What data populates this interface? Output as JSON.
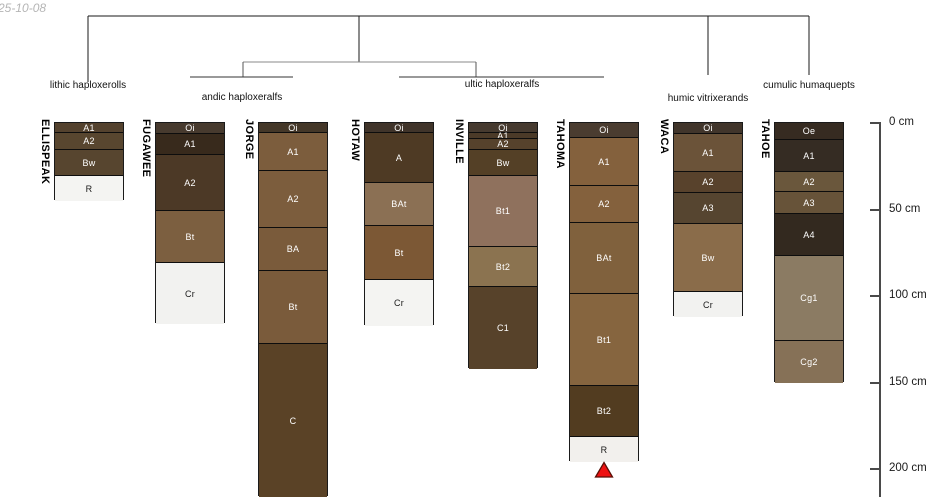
{
  "meta": {
    "date_label": "25-10-08"
  },
  "chart_data": {
    "type": "bar",
    "subtype": "stacked-soil-profile-sketch",
    "title": "",
    "depth_axis": {
      "unit": "cm",
      "position": "right",
      "range": [
        0,
        216
      ],
      "tick_values": [
        0,
        50,
        100,
        150,
        200
      ],
      "tick_labels": [
        "0 cm",
        "50 cm",
        "100 cm",
        "150 cm",
        "200 cm"
      ]
    },
    "dendrogram_groups": [
      {
        "label": "lithic haploxerolls",
        "members": [
          "ELLISPEAK"
        ]
      },
      {
        "label": "andic haploxeralfs",
        "members": [
          "FUGAWEE",
          "JORGE"
        ]
      },
      {
        "label": "ultic haploxeralfs",
        "members": [
          "HOTAW",
          "INVILLE",
          "TAHOMA"
        ]
      },
      {
        "label": "humic vitrixerands",
        "members": [
          "WACA"
        ]
      },
      {
        "label": "cumulic humaquepts",
        "members": [
          "TAHOE"
        ]
      }
    ],
    "profiles": [
      {
        "name": "ELLISPEAK",
        "group": "lithic haploxerolls",
        "horizons": [
          {
            "name": "A1",
            "top_cm": 0,
            "bottom_cm": 5,
            "color": "#54422e",
            "label_color": "#ffffff"
          },
          {
            "name": "A2",
            "top_cm": 5,
            "bottom_cm": 15,
            "color": "#58462f",
            "label_color": "#ffffff"
          },
          {
            "name": "Bw",
            "top_cm": 15,
            "bottom_cm": 30,
            "color": "#57452f",
            "label_color": "#ffffff"
          },
          {
            "name": "R",
            "top_cm": 30,
            "bottom_cm": 45,
            "color": "#f4f4f2",
            "label_color": "#1a1a1a"
          }
        ]
      },
      {
        "name": "FUGAWEE",
        "group": "andic haploxeralfs",
        "horizons": [
          {
            "name": "Oi",
            "top_cm": 0,
            "bottom_cm": 6,
            "color": "#473a2e",
            "label_color": "#ffffff"
          },
          {
            "name": "A1",
            "top_cm": 6,
            "bottom_cm": 18,
            "color": "#382a1c",
            "label_color": "#ffffff"
          },
          {
            "name": "A2",
            "top_cm": 18,
            "bottom_cm": 50,
            "color": "#4c3926",
            "label_color": "#ffffff"
          },
          {
            "name": "Bt",
            "top_cm": 50,
            "bottom_cm": 80,
            "color": "#7c5f40",
            "label_color": "#ffffff"
          },
          {
            "name": "Cr",
            "top_cm": 80,
            "bottom_cm": 116,
            "color": "#f2f2f0",
            "label_color": "#1a1a1a"
          }
        ]
      },
      {
        "name": "JORGE",
        "group": "andic haploxeralfs",
        "horizons": [
          {
            "name": "Oi",
            "top_cm": 0,
            "bottom_cm": 5,
            "color": "#443728",
            "label_color": "#ffffff"
          },
          {
            "name": "A1",
            "top_cm": 5,
            "bottom_cm": 27,
            "color": "#7c5d3d",
            "label_color": "#ffffff"
          },
          {
            "name": "A2",
            "top_cm": 27,
            "bottom_cm": 60,
            "color": "#7c5d3d",
            "label_color": "#ffffff"
          },
          {
            "name": "BA",
            "top_cm": 60,
            "bottom_cm": 85,
            "color": "#7a5b3b",
            "label_color": "#ffffff"
          },
          {
            "name": "Bt",
            "top_cm": 85,
            "bottom_cm": 127,
            "color": "#7a5b3b",
            "label_color": "#ffffff"
          },
          {
            "name": "C",
            "top_cm": 127,
            "bottom_cm": 216,
            "color": "#5a4226",
            "label_color": "#ffffff"
          }
        ]
      },
      {
        "name": "HOTAW",
        "group": "ultic haploxeralfs",
        "horizons": [
          {
            "name": "Oi",
            "top_cm": 0,
            "bottom_cm": 5,
            "color": "#40342a",
            "label_color": "#ffffff"
          },
          {
            "name": "A",
            "top_cm": 5,
            "bottom_cm": 34,
            "color": "#4e3a24",
            "label_color": "#ffffff"
          },
          {
            "name": "BAt",
            "top_cm": 34,
            "bottom_cm": 59,
            "color": "#8b7054",
            "label_color": "#ffffff"
          },
          {
            "name": "Bt",
            "top_cm": 59,
            "bottom_cm": 90,
            "color": "#7c5835",
            "label_color": "#ffffff"
          },
          {
            "name": "Cr",
            "top_cm": 90,
            "bottom_cm": 117,
            "color": "#f4f4f2",
            "label_color": "#1a1a1a"
          }
        ]
      },
      {
        "name": "INVILLE",
        "group": "ultic haploxeralfs",
        "horizons": [
          {
            "name": "Oi",
            "top_cm": 0,
            "bottom_cm": 5,
            "color": "#463a2f",
            "label_color": "#ffffff"
          },
          {
            "name": "A1",
            "top_cm": 5,
            "bottom_cm": 8.5,
            "color": "#4b3a28",
            "label_color": "#ffffff"
          },
          {
            "name": "A2",
            "top_cm": 8.5,
            "bottom_cm": 15,
            "color": "#56422c",
            "label_color": "#ffffff"
          },
          {
            "name": "Bw",
            "top_cm": 15,
            "bottom_cm": 30,
            "color": "#544026",
            "label_color": "#ffffff"
          },
          {
            "name": "Bt1",
            "top_cm": 30,
            "bottom_cm": 71,
            "color": "#8f715d",
            "label_color": "#ffffff"
          },
          {
            "name": "Bt2",
            "top_cm": 71,
            "bottom_cm": 94,
            "color": "#8b7350",
            "label_color": "#ffffff"
          },
          {
            "name": "C1",
            "top_cm": 94,
            "bottom_cm": 142,
            "color": "#57422a",
            "label_color": "#ffffff"
          }
        ]
      },
      {
        "name": "TAHOMA",
        "group": "ultic haploxeralfs",
        "horizons": [
          {
            "name": "Oi",
            "top_cm": 0,
            "bottom_cm": 8,
            "color": "#4a3c30",
            "label_color": "#ffffff"
          },
          {
            "name": "A1",
            "top_cm": 8,
            "bottom_cm": 36,
            "color": "#84613d",
            "label_color": "#ffffff"
          },
          {
            "name": "A2",
            "top_cm": 36,
            "bottom_cm": 57,
            "color": "#84613d",
            "label_color": "#ffffff"
          },
          {
            "name": "BAt",
            "top_cm": 57,
            "bottom_cm": 98,
            "color": "#80613d",
            "label_color": "#ffffff"
          },
          {
            "name": "Bt1",
            "top_cm": 98,
            "bottom_cm": 151,
            "color": "#86653f",
            "label_color": "#ffffff"
          },
          {
            "name": "Bt2",
            "top_cm": 151,
            "bottom_cm": 181,
            "color": "#523c20",
            "label_color": "#ffffff"
          },
          {
            "name": "R",
            "top_cm": 181,
            "bottom_cm": 196,
            "color": "#f2f0ed",
            "label_color": "#1a1a1a"
          }
        ]
      },
      {
        "name": "WACA",
        "group": "humic vitrixerands",
        "horizons": [
          {
            "name": "Oi",
            "top_cm": 0,
            "bottom_cm": 6,
            "color": "#41352b",
            "label_color": "#ffffff"
          },
          {
            "name": "A1",
            "top_cm": 6,
            "bottom_cm": 28,
            "color": "#6b5339",
            "label_color": "#ffffff"
          },
          {
            "name": "A2",
            "top_cm": 28,
            "bottom_cm": 40,
            "color": "#58422c",
            "label_color": "#ffffff"
          },
          {
            "name": "A3",
            "top_cm": 40,
            "bottom_cm": 58,
            "color": "#564530",
            "label_color": "#ffffff"
          },
          {
            "name": "Bw",
            "top_cm": 58,
            "bottom_cm": 97,
            "color": "#8a6c4a",
            "label_color": "#ffffff"
          },
          {
            "name": "Cr",
            "top_cm": 97,
            "bottom_cm": 112,
            "color": "#f2f2f0",
            "label_color": "#1a1a1a"
          }
        ]
      },
      {
        "name": "TAHOE",
        "group": "cumulic humaquepts",
        "horizons": [
          {
            "name": "Oe",
            "top_cm": 0,
            "bottom_cm": 9,
            "color": "#362b21",
            "label_color": "#ffffff"
          },
          {
            "name": "A1",
            "top_cm": 9,
            "bottom_cm": 28,
            "color": "#352c23",
            "label_color": "#ffffff"
          },
          {
            "name": "A2",
            "top_cm": 28,
            "bottom_cm": 39,
            "color": "#6a573c",
            "label_color": "#ffffff"
          },
          {
            "name": "A3",
            "top_cm": 39,
            "bottom_cm": 52,
            "color": "#675339",
            "label_color": "#ffffff"
          },
          {
            "name": "A4",
            "top_cm": 52,
            "bottom_cm": 76,
            "color": "#33291f",
            "label_color": "#ffffff"
          },
          {
            "name": "Cg1",
            "top_cm": 76,
            "bottom_cm": 125,
            "color": "#8b7b63",
            "label_color": "#ffffff"
          },
          {
            "name": "Cg2",
            "top_cm": 125,
            "bottom_cm": 150,
            "color": "#867157",
            "label_color": "#ffffff"
          }
        ]
      }
    ],
    "annotations": [
      {
        "type": "triangle-marker",
        "profile": "TAHOMA",
        "position": "below R horizon",
        "color": "#ee1111"
      }
    ],
    "colors": {
      "line": "#1a1a1a",
      "connector_gray": "#8a8a8a",
      "axis": "#4a4a4a",
      "marker_red": "#ee1111"
    }
  }
}
